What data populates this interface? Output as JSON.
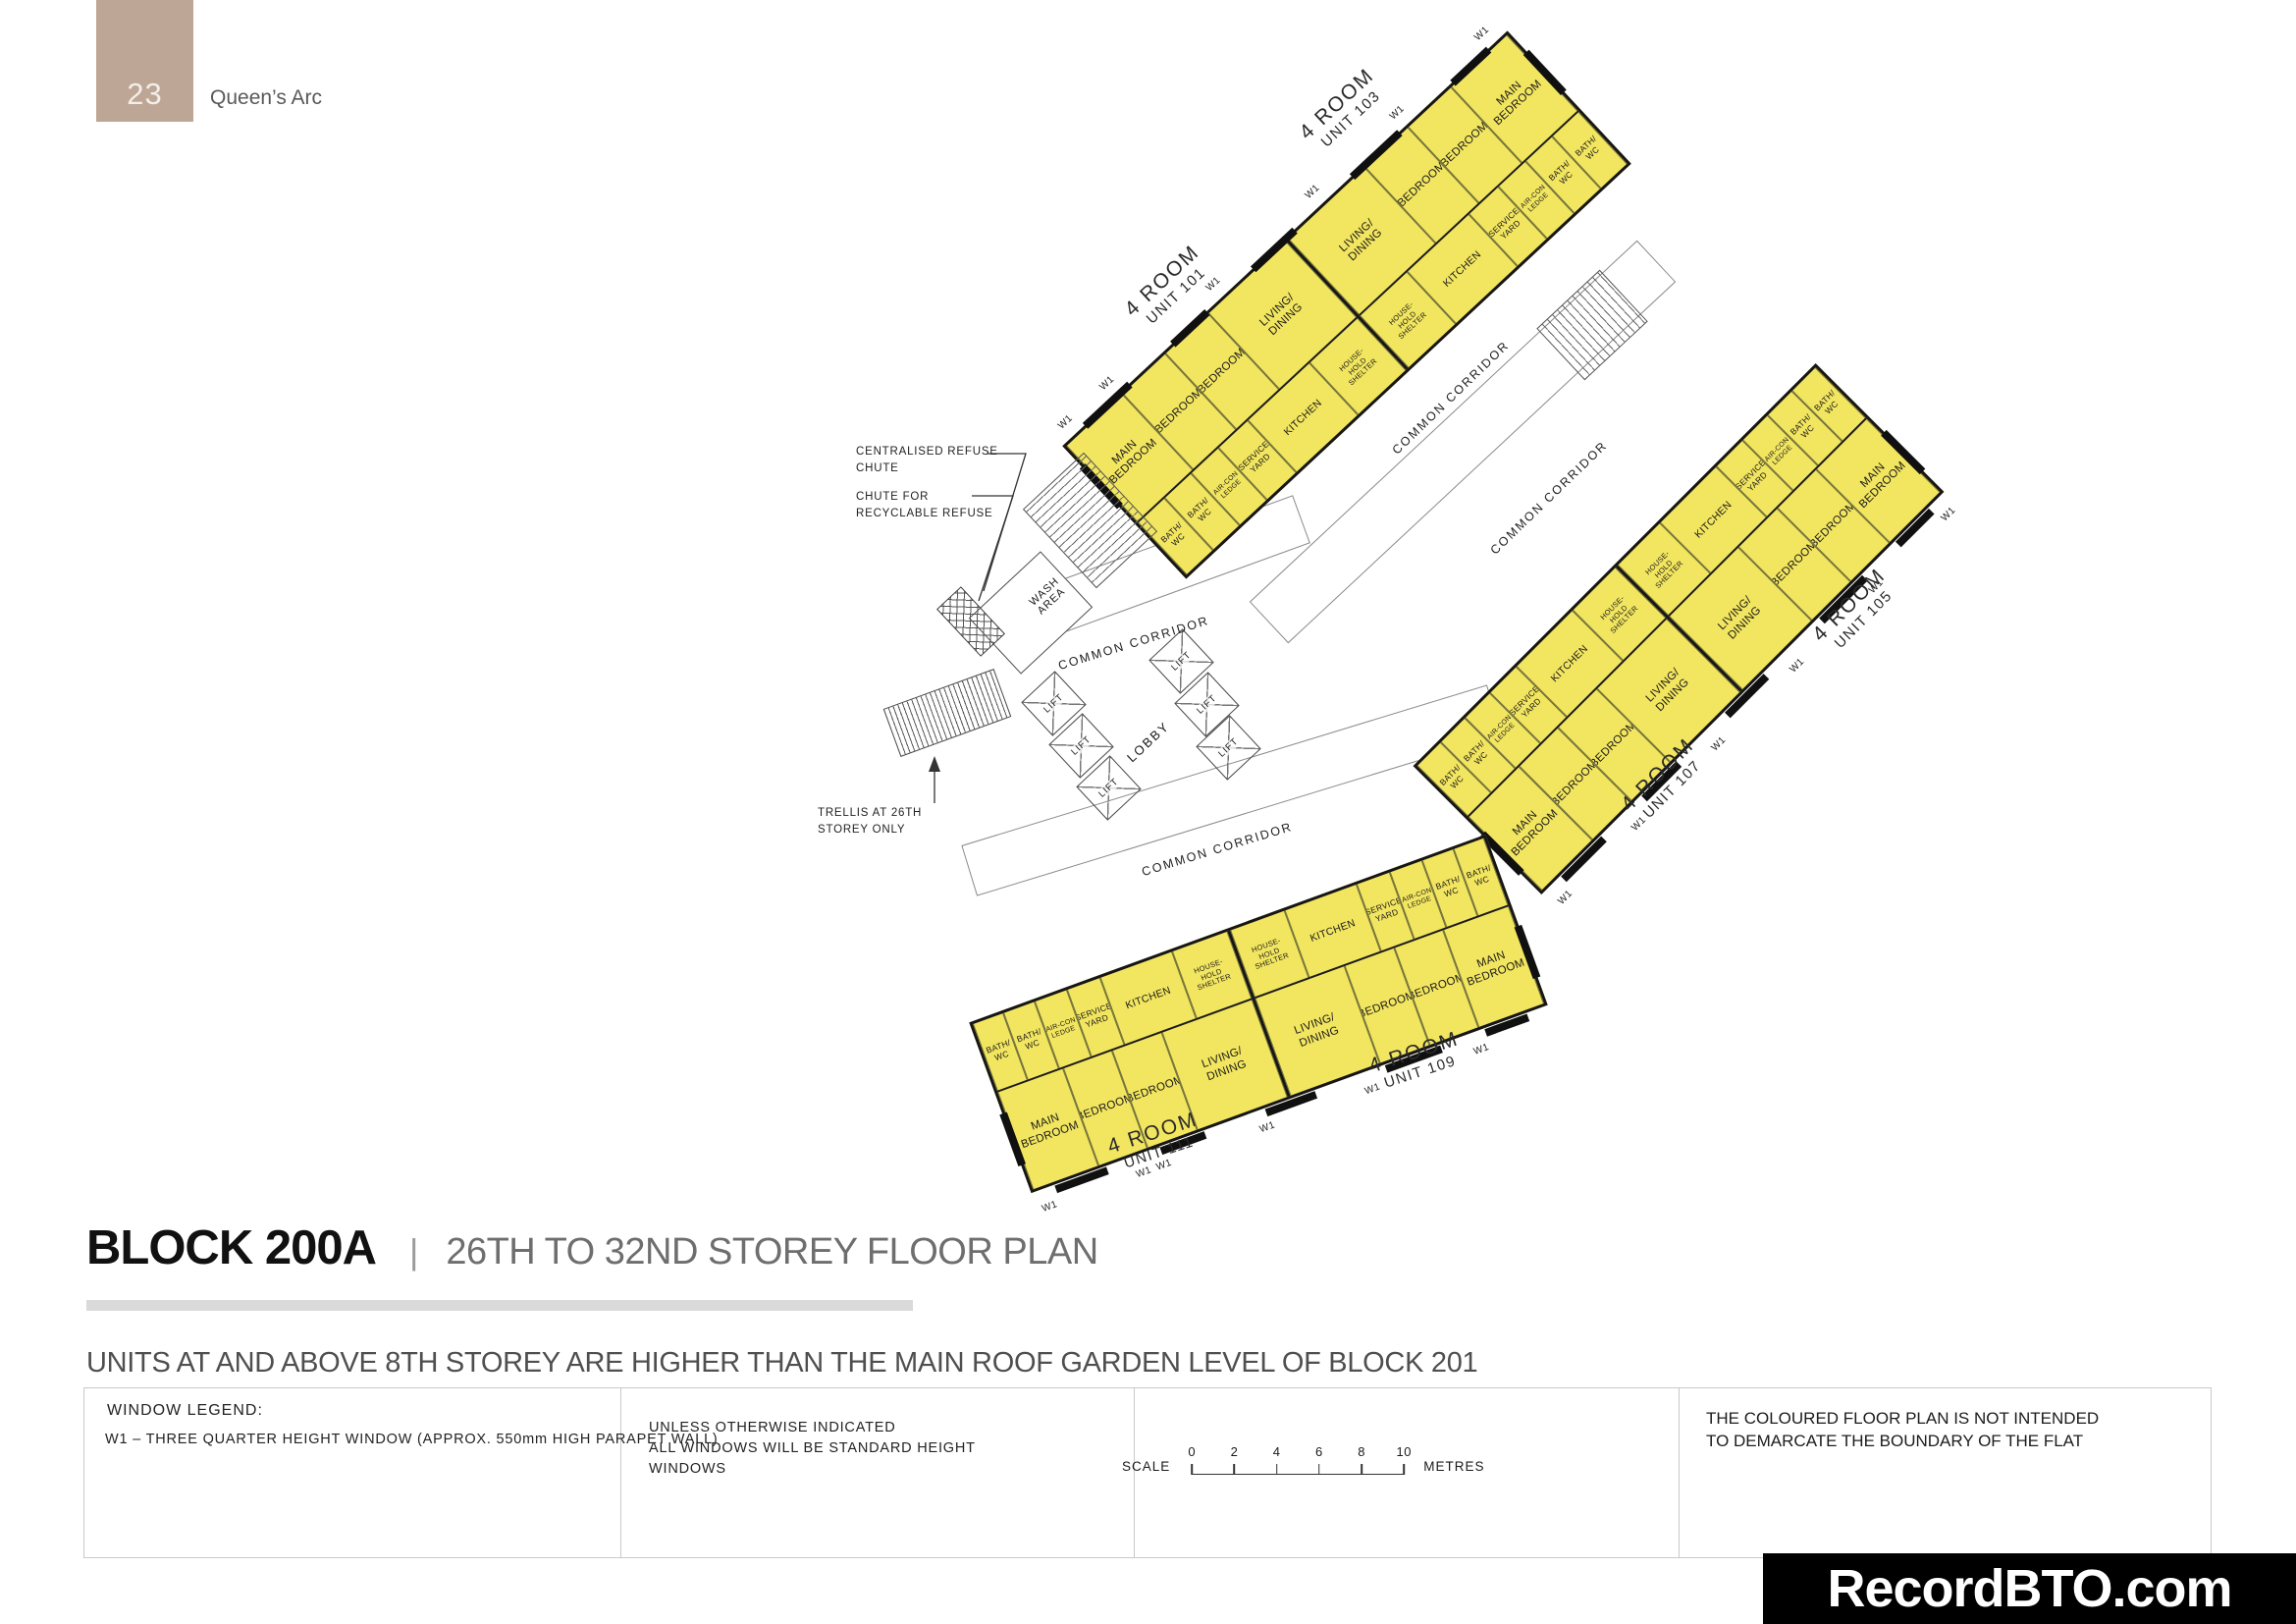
{
  "page": {
    "number": "23",
    "project": "Queen’s Arc"
  },
  "title": {
    "block": "BLOCK 200A",
    "separator": "|",
    "plan_title": "26TH TO 32ND  STOREY FLOOR PLAN",
    "note": "UNITS AT AND ABOVE 8TH STOREY ARE HIGHER THAN THE MAIN ROOF GARDEN LEVEL OF BLOCK 201"
  },
  "legend": {
    "window_legend_title": "WINDOW LEGEND:",
    "window_legend_item": "W1  –  THREE QUARTER HEIGHT WINDOW (APPROX. 550mm HIGH PARAPET WALL)",
    "windows_note": "UNLESS OTHERWISE INDICATED\nALL WINDOWS WILL BE STANDARD HEIGHT\nWINDOWS",
    "scale": {
      "label": "SCALE",
      "ticks": [
        "0",
        "2",
        "4",
        "6",
        "8",
        "10"
      ],
      "unit": "METRES"
    },
    "boundary_note": "THE COLOURED FLOOR PLAN IS NOT INTENDED\nTO DEMARCATE THE BOUNDARY OF THE FLAT"
  },
  "watermark": "RecordBTO.com",
  "plan": {
    "annotations": {
      "centralised_refuse": "CENTRALISED REFUSE\nCHUTE",
      "recyclable_refuse": "CHUTE FOR\nRECYCLABLE REFUSE",
      "trellis": "TRELLIS AT 26TH\nSTOREY ONLY",
      "wash_area": "WASH\nAREA",
      "lobby": "LOBBY",
      "lift": "LIFT",
      "common_corridor": "COMMON CORRIDOR",
      "window_marker": "W1"
    },
    "room_labels": {
      "main_bedroom": "MAIN\nBEDROOM",
      "bedroom": "BEDROOM",
      "living_dining": "LIVING/\nDINING",
      "kitchen": "KITCHEN",
      "bath_wc": "BATH/\nWC",
      "service_yard": "SERVICE\nYARD",
      "aircon_ledge": "AIR-CON\nLEDGE",
      "household_shelter": "HOUSE-\nHOLD\nSHELTER"
    },
    "units": [
      {
        "type": "4 ROOM",
        "unit": "UNIT 101",
        "rooms": [
          "MAIN BEDROOM",
          "BEDROOM",
          "BEDROOM",
          "LIVING/DINING",
          "KITCHEN",
          "BATH/WC",
          "BATH/WC",
          "SERVICE YARD",
          "AIR-CON LEDGE",
          "HOUSEHOLD SHELTER"
        ]
      },
      {
        "type": "4 ROOM",
        "unit": "UNIT 103",
        "rooms": [
          "MAIN BEDROOM",
          "BEDROOM",
          "BEDROOM",
          "LIVING/DINING",
          "KITCHEN",
          "BATH/WC",
          "BATH/WC",
          "SERVICE YARD",
          "AIR-CON LEDGE",
          "HOUSEHOLD SHELTER"
        ]
      },
      {
        "type": "4 ROOM",
        "unit": "UNIT 105",
        "rooms": [
          "MAIN BEDROOM",
          "BEDROOM",
          "BEDROOM",
          "LIVING/DINING",
          "KITCHEN",
          "BATH/WC",
          "BATH/WC",
          "SERVICE YARD",
          "AIR-CON LEDGE",
          "HOUSEHOLD SHELTER"
        ]
      },
      {
        "type": "4 ROOM",
        "unit": "UNIT 107",
        "rooms": [
          "MAIN BEDROOM",
          "BEDROOM",
          "BEDROOM",
          "LIVING/DINING",
          "KITCHEN",
          "BATH/WC",
          "BATH/WC",
          "SERVICE YARD",
          "AIR-CON LEDGE",
          "HOUSEHOLD SHELTER"
        ]
      },
      {
        "type": "4 ROOM",
        "unit": "UNIT 109",
        "rooms": [
          "MAIN BEDROOM",
          "BEDROOM",
          "BEDROOM",
          "LIVING/DINING",
          "KITCHEN",
          "BATH/WC",
          "BATH/WC",
          "SERVICE YARD",
          "AIR-CON LEDGE",
          "HOUSEHOLD SHELTER"
        ]
      },
      {
        "type": "4 ROOM",
        "unit": "UNIT 111",
        "rooms": [
          "MAIN BEDROOM",
          "BEDROOM",
          "BEDROOM",
          "LIVING/DINING",
          "KITCHEN",
          "BATH/WC",
          "BATH/WC",
          "SERVICE YARD",
          "AIR-CON LEDGE",
          "HOUSEHOLD SHELTER"
        ]
      }
    ]
  }
}
